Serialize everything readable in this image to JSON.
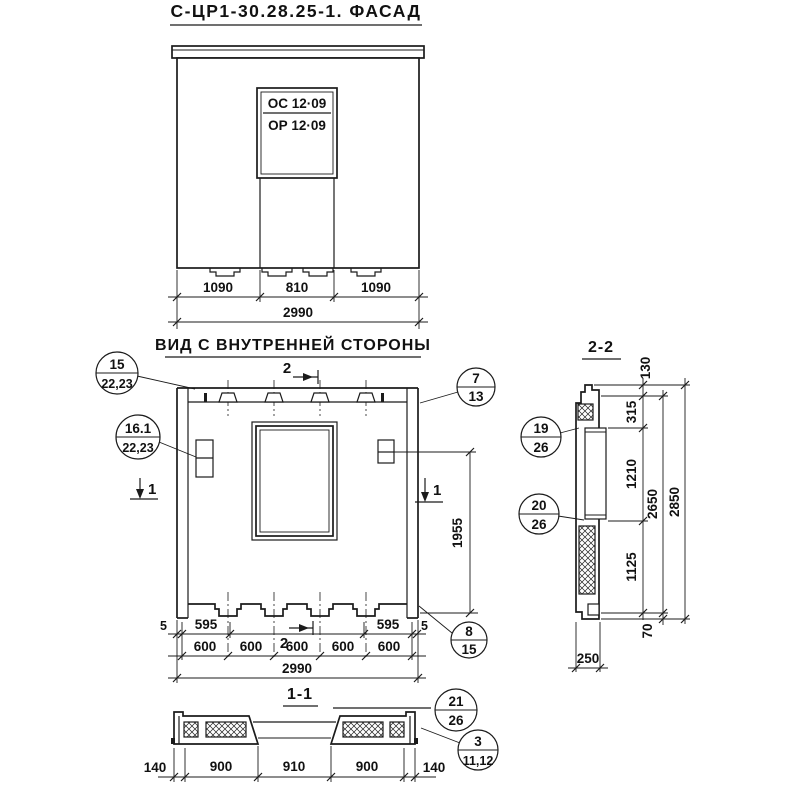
{
  "page": {
    "background": "#ffffff",
    "ink": "#1b1b1b"
  },
  "titles": {
    "main": "С-ЦР1-30.28.25-1. ФАСАД",
    "inner_view": "ВИД С ВНУТРЕННЕЙ СТОРОНЫ",
    "section_2_2": "2-2",
    "section_1_1": "1-1"
  },
  "facade": {
    "window_mark_line1": "ОС 12·09",
    "window_mark_line2": "ОР 12·09",
    "dims": {
      "left": "1090",
      "mid": "810",
      "right": "1090",
      "total": "2990"
    }
  },
  "inner": {
    "dims": {
      "gap_left": "5",
      "seg_left": "595",
      "seg_right": "595",
      "gap_right": "5",
      "spacing": [
        "600",
        "600",
        "600",
        "600",
        "600"
      ],
      "total": "2990",
      "height": "1955"
    },
    "marks": {
      "cut2": "2",
      "cut1": "1"
    }
  },
  "section22": {
    "dims": {
      "d130": "130",
      "d315": "315",
      "d1210": "1210",
      "d1125": "1125",
      "d70": "70",
      "d2650": "2650",
      "d2850": "2850",
      "d250": "250"
    }
  },
  "section11": {
    "dims": {
      "left_edge": "140",
      "left": "900",
      "mid": "910",
      "right": "900",
      "right_edge": "140"
    }
  },
  "callouts": {
    "c15": {
      "num": "15",
      "sheet": "22,23"
    },
    "c16": {
      "num": "16.1",
      "sheet": "22,23"
    },
    "c7": {
      "num": "7",
      "sheet": "13"
    },
    "c8": {
      "num": "8",
      "sheet": "15"
    },
    "c19": {
      "num": "19",
      "sheet": "26"
    },
    "c20": {
      "num": "20",
      "sheet": "26"
    },
    "c21": {
      "num": "21",
      "sheet": "26"
    },
    "c3": {
      "num": "3",
      "sheet": "11,12"
    }
  }
}
